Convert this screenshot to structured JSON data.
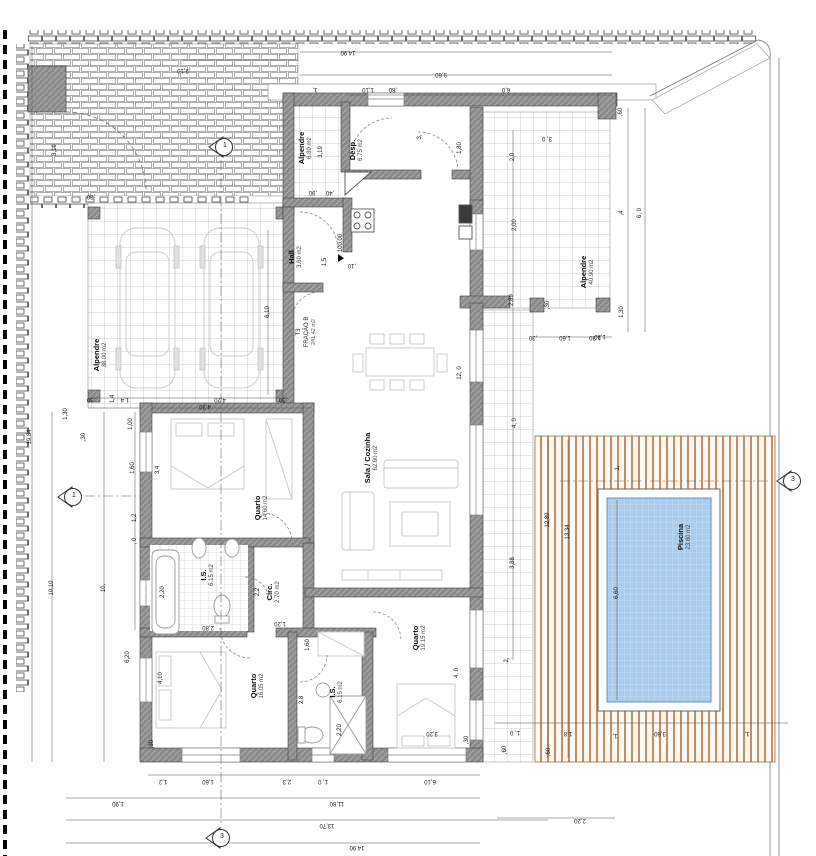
{
  "title": "Planta de arquitetura - Fração B (T3) com piscina",
  "colors": {
    "wall": "#8a8a8a",
    "wall_edge": "#3f3f3f",
    "pool_water": "#a9cdee",
    "pool_grid": "#cfe2f8",
    "deck_stripe": "#bf7a48",
    "tile_line": "#bfbfbf",
    "brick_line": "#8f8f8f",
    "dim_text": "#1c1c1c"
  },
  "unit": {
    "l1": "T3",
    "l2": "FRAÇÃO B",
    "l3": "241.42 m2",
    "x": 307,
    "y": 332
  },
  "level": {
    "text": "100.00",
    "x": 341,
    "y": 248
  },
  "rooms": [
    {
      "name": "Alpendre",
      "area": "38.00 m2",
      "x": 101,
      "y": 355
    },
    {
      "name": "Alpendre",
      "area": "6.80 m2",
      "x": 306,
      "y": 148
    },
    {
      "name": "Desp.",
      "area": "6.75 m2",
      "x": 357,
      "y": 150
    },
    {
      "name": "Hall",
      "area": "3.60 m2",
      "x": 296,
      "y": 257
    },
    {
      "name": "Sala / Cozinha",
      "area": "62.60 m2",
      "x": 372,
      "y": 458
    },
    {
      "name": "Quarto",
      "area": "14.60 m2",
      "x": 262,
      "y": 508
    },
    {
      "name": "I.S.",
      "area": "6.15 m2",
      "x": 208,
      "y": 575
    },
    {
      "name": "Circ.",
      "area": "2.70 m2",
      "x": 274,
      "y": 592
    },
    {
      "name": "Quarto",
      "area": "16.05 m2",
      "x": 258,
      "y": 686
    },
    {
      "name": "I.S.",
      "area": "6.15 m2",
      "x": 337,
      "y": 692
    },
    {
      "name": "Quarto",
      "area": "19.15 m2",
      "x": 420,
      "y": 638
    },
    {
      "name": "Alpendre",
      "area": "40.90 m2",
      "x": 588,
      "y": 272
    },
    {
      "name": "Piscina",
      "area": "23.80 m2",
      "x": 685,
      "y": 537
    }
  ],
  "markers": [
    {
      "label": "1",
      "x": 221,
      "y": 147
    },
    {
      "label": "1",
      "x": 70,
      "y": 497
    },
    {
      "label": "3",
      "x": 789,
      "y": 481
    },
    {
      "label": "3",
      "x": 218,
      "y": 838
    }
  ],
  "dims": [
    [
      "19,84",
      30,
      437,
      -90
    ],
    [
      "10,10",
      52,
      588,
      -90
    ],
    [
      "10,",
      104,
      588,
      -90
    ],
    [
      "3,19",
      55,
      150,
      -90
    ],
    [
      "1,30",
      66,
      414,
      -90
    ],
    [
      ",30",
      84,
      437,
      -90
    ],
    [
      "1,4",
      113,
      399,
      -90
    ],
    [
      "1,00",
      131,
      424,
      -90
    ],
    [
      "1,60",
      133,
      468,
      -90
    ],
    [
      "1,2",
      135,
      518,
      -90
    ],
    [
      ", 0",
      135,
      541,
      -90
    ],
    [
      "3,4",
      158,
      470,
      -90
    ],
    [
      "6,20",
      128,
      657,
      -90
    ],
    [
      "4,10",
      161,
      678,
      -90
    ],
    [
      "2,20",
      163,
      592,
      -90
    ],
    [
      "6,10",
      268,
      312,
      -90
    ],
    [
      "4,20",
      220,
      399,
      180
    ],
    [
      "1,4",
      125,
      399,
      180
    ],
    [
      ",30",
      91,
      399,
      180
    ],
    [
      ",30",
      283,
      399,
      180
    ],
    [
      ",30",
      91,
      196,
      180
    ],
    [
      "4,30",
      205,
      406,
      180
    ],
    [
      "9,10",
      183,
      70,
      180
    ],
    [
      "14,90",
      348,
      52,
      180
    ],
    [
      "9,60",
      441,
      74,
      180
    ],
    [
      "1,",
      315,
      89,
      180
    ],
    [
      "1,10",
      368,
      89,
      180
    ],
    [
      ",80",
      393,
      89,
      180
    ],
    [
      "6,0",
      506,
      89,
      180
    ],
    [
      ",60",
      621,
      112,
      -90
    ],
    [
      ",4",
      622,
      213,
      -90
    ],
    [
      "6, 0",
      640,
      213,
      -90
    ],
    [
      "1,30",
      622,
      312,
      -90
    ],
    [
      "1,30",
      600,
      336,
      180
    ],
    [
      "3, 0",
      547,
      138,
      180
    ],
    [
      "2,0",
      513,
      157,
      -90
    ],
    [
      "2,00",
      515,
      225,
      -90
    ],
    [
      "2,89",
      512,
      300,
      -90
    ],
    [
      ",30",
      548,
      305,
      -90
    ],
    [
      "1,80",
      460,
      148,
      -90
    ],
    [
      "3,",
      420,
      137,
      -90
    ],
    [
      ",90",
      313,
      192,
      180
    ],
    [
      ",40",
      330,
      192,
      180
    ],
    [
      "3,19",
      321,
      152,
      -90
    ],
    [
      "1,5",
      325,
      262,
      -90
    ],
    [
      ",10",
      352,
      265,
      180
    ],
    [
      "12, 0",
      460,
      373,
      -90
    ],
    [
      "4, 0",
      515,
      423,
      -90
    ],
    [
      "3,88",
      513,
      563,
      -90
    ],
    [
      "2,",
      507,
      660,
      -90
    ],
    [
      ",30",
      533,
      337,
      180
    ],
    [
      "1,60",
      565,
      337,
      180
    ],
    [
      "1,30",
      595,
      337,
      180
    ],
    [
      "12,89",
      548,
      520,
      -90
    ],
    [
      "13,34",
      568,
      532,
      -90
    ],
    [
      "6,60",
      617,
      593,
      -90
    ],
    [
      "1,",
      618,
      468,
      -90
    ],
    [
      "1, 0",
      515,
      732,
      180
    ],
    [
      "1,8",
      568,
      733,
      180
    ],
    [
      "1,",
      615,
      735,
      180
    ],
    [
      "3,60",
      660,
      733,
      180
    ],
    [
      "1,",
      747,
      733,
      180
    ],
    [
      ",60",
      549,
      752,
      -90
    ],
    [
      ",60",
      505,
      750,
      -90
    ],
    [
      "2,20",
      580,
      820,
      180
    ],
    [
      "1,2",
      163,
      781,
      180
    ],
    [
      "1,60",
      208,
      781,
      180
    ],
    [
      "2,3",
      287,
      781,
      180
    ],
    [
      "1, 0",
      323,
      781,
      180
    ],
    [
      "6,10",
      430,
      781,
      180
    ],
    [
      "1,90",
      118,
      803,
      180
    ],
    [
      "11,80",
      337,
      803,
      180
    ],
    [
      "13,70",
      327,
      825,
      180
    ],
    [
      "14,90",
      357,
      847,
      180
    ],
    [
      "2,80",
      208,
      627,
      180
    ],
    [
      "1,20",
      280,
      623,
      180
    ],
    [
      "1,60",
      308,
      645,
      -90
    ],
    [
      "2,2",
      258,
      592,
      -90
    ],
    [
      "2,8",
      302,
      700,
      -90
    ],
    [
      "2,20",
      340,
      730,
      -90
    ],
    [
      "3,20",
      432,
      733,
      180
    ],
    [
      "4, 0",
      457,
      673,
      -90
    ],
    [
      ",30",
      152,
      744,
      -90
    ],
    [
      ",30",
      467,
      740,
      -90
    ]
  ]
}
